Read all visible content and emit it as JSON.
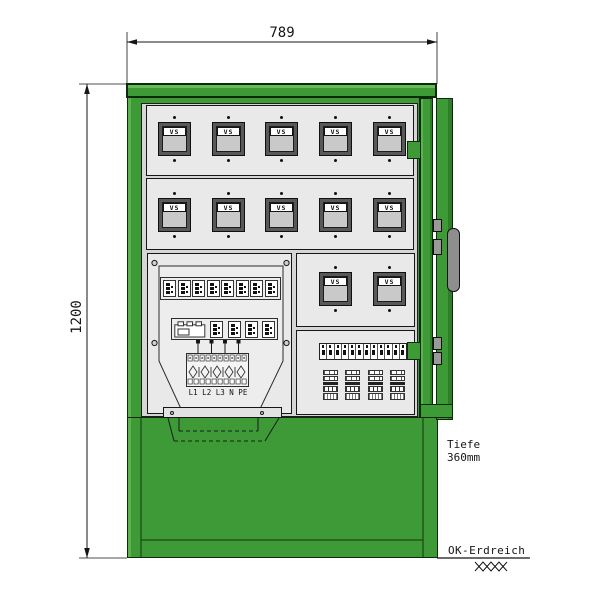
{
  "drawing": {
    "dimension_width": "789",
    "dimension_height": "1200",
    "depth_line1": "Tiefe",
    "depth_line2": "360mm",
    "ground_label": "OK-Erdreich",
    "meter_label": "VS",
    "phase_label": "L1 L2 L3 N PE"
  },
  "counts": {
    "meters_row1": 5,
    "meters_row2": 5,
    "meters_row3": 2,
    "breakers_row1": 8,
    "breakers_row2": 4,
    "din_breakers": 12,
    "terminal_groups": 4
  },
  "colors": {
    "cabinet_green": "#3d9a36",
    "cabinet_green_light": "#5cb24d",
    "cabinet_green_dark": "#0d2a0b",
    "panel_light_gray": "#e9e9e9",
    "interior_gray": "#d6d6d6",
    "meter_frame_gray": "#585858",
    "meter_face_gray": "#c9c9c9",
    "handle_gray": "#8e8e8e",
    "line_black": "#111111",
    "background": "#ffffff"
  }
}
